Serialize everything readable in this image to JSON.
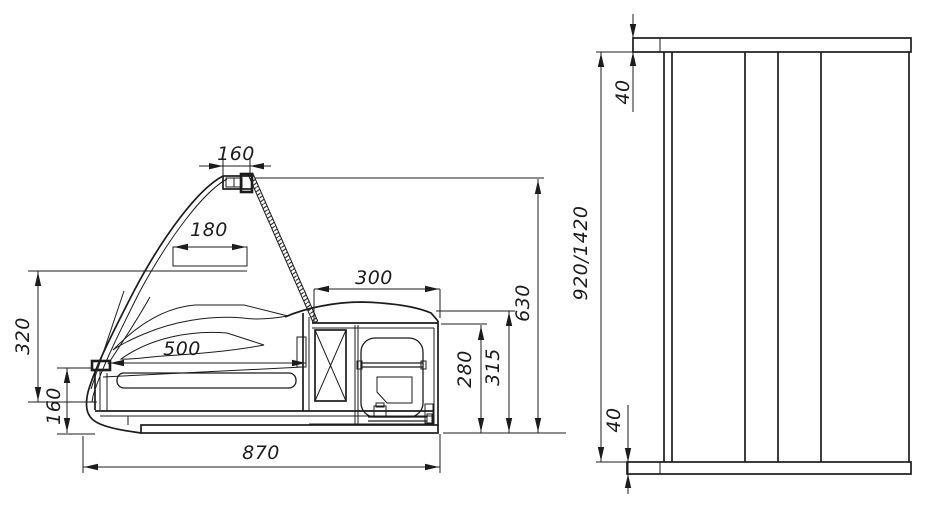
{
  "colors": {
    "ink": "#1c1c1c",
    "paper": "#ffffff"
  },
  "drawing": {
    "side_view": {
      "dims": {
        "lamp_width": "160",
        "shelf_depth": "180",
        "machine_depth": "300",
        "well_depth": "500",
        "overall_depth": "870",
        "glass_height": "320",
        "front_height": "160",
        "machine_height": "280",
        "counter_height": "315",
        "overall_height": "630"
      }
    },
    "front_view": {
      "dims": {
        "top_panel_thickness": "40",
        "overall_height": "920/1420",
        "base_thickness": "40"
      }
    }
  }
}
